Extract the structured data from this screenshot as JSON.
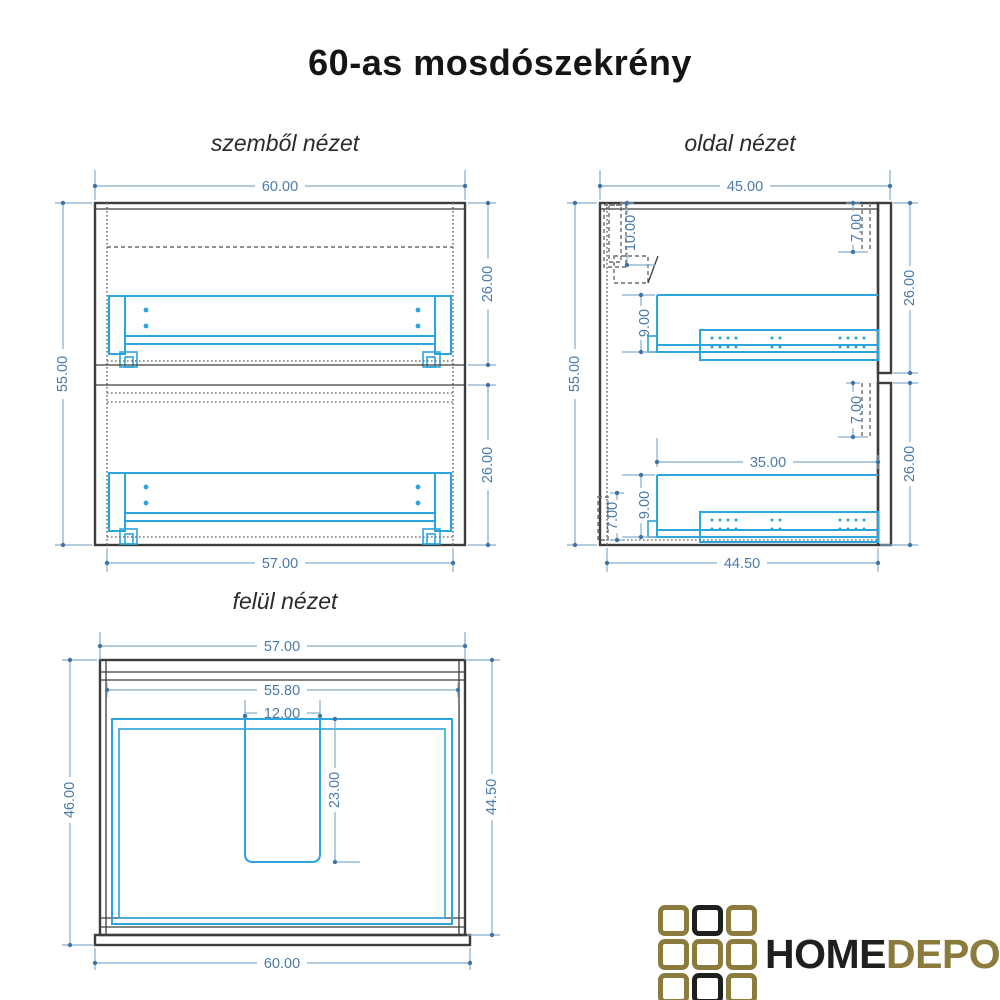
{
  "title": "60-as mosdószekrény",
  "views": {
    "front": {
      "label": "szemből nézet",
      "dims": {
        "width_top": "60.00",
        "height_left": "55.00",
        "section_upper": "26.00",
        "section_lower": "26.00",
        "width_bottom": "57.00"
      }
    },
    "side": {
      "label": "oldal nézet",
      "dims": {
        "depth_top": "45.00",
        "height_left": "55.00",
        "bracket_height": "10.00",
        "front_inset_top": "7.00",
        "section_upper": "26.00",
        "rail_height_upper": "9.00",
        "front_inset_middle": "7.00",
        "rail_length": "35.00",
        "back_rail_height": "7.00",
        "rail_height_lower": "9.00",
        "section_lower": "26.00",
        "depth_bottom": "44.50"
      }
    },
    "top": {
      "label": "felül nézet",
      "dims": {
        "width_top": "57.00",
        "width_inner": "55.80",
        "cutout_width": "12.00",
        "cutout_depth": "23.00",
        "depth_left": "46.00",
        "depth_right": "44.50",
        "width_bottom": "60.00"
      }
    }
  },
  "logo": {
    "brand_primary": "HOME",
    "brand_secondary": "DEPO",
    "colors": {
      "gold": "#8b7b3c",
      "dark": "#1f1f1f"
    },
    "grid": [
      [
        "gold",
        "dark",
        "gold"
      ],
      [
        "gold",
        "gold",
        "gold"
      ],
      [
        "gold",
        "dark",
        "gold"
      ]
    ]
  },
  "colors": {
    "dimension_text": "#4a7aa8",
    "dimension_line": "#85accb",
    "drawing_accent": "#2ca5dc",
    "outline": "#3d3d3d"
  }
}
